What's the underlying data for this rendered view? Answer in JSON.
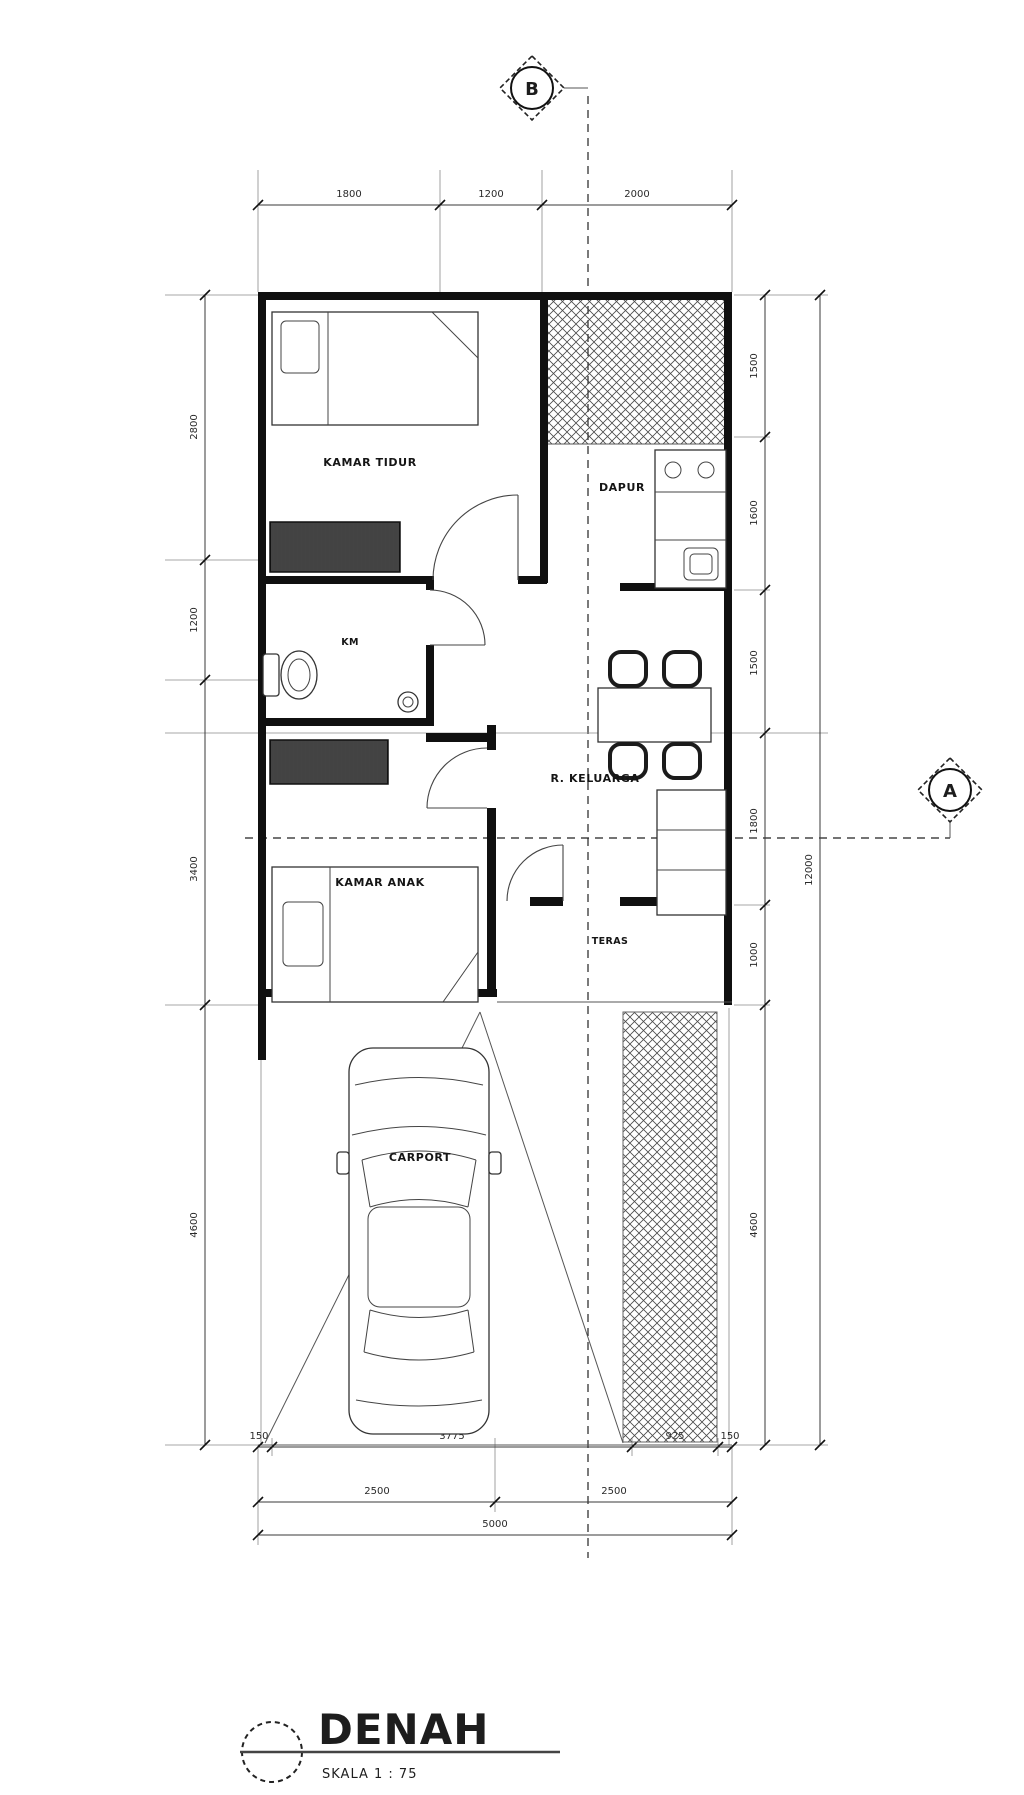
{
  "drawing": {
    "title": "DENAH",
    "scale": "SKALA 1 : 75"
  },
  "markers": {
    "section_b": "B",
    "section_a": "A"
  },
  "rooms": {
    "bedroom1": "KAMAR TIDUR",
    "kitchen": "DAPUR",
    "bathroom": "KM",
    "family_room": "R. KELUARGA",
    "bedroom2": "KAMAR ANAK",
    "porch": "TERAS",
    "carport": "CARPORT"
  },
  "dimensions": {
    "top": [
      "1800",
      "1200",
      "2000"
    ],
    "left": [
      "2800",
      "1200",
      "3400",
      "4600"
    ],
    "right_inner": [
      "1500",
      "1600",
      "1500",
      "1800",
      "1000",
      "4600"
    ],
    "right_total": "12000",
    "bottom_row1": [
      "150",
      "3775",
      "925",
      "150"
    ],
    "bottom_row2": [
      "2500",
      "2500"
    ],
    "bottom_total": "5000"
  },
  "colors": {
    "wall": "#101010",
    "paper": "#ffffff",
    "dim_text": "#2a2a2a"
  }
}
